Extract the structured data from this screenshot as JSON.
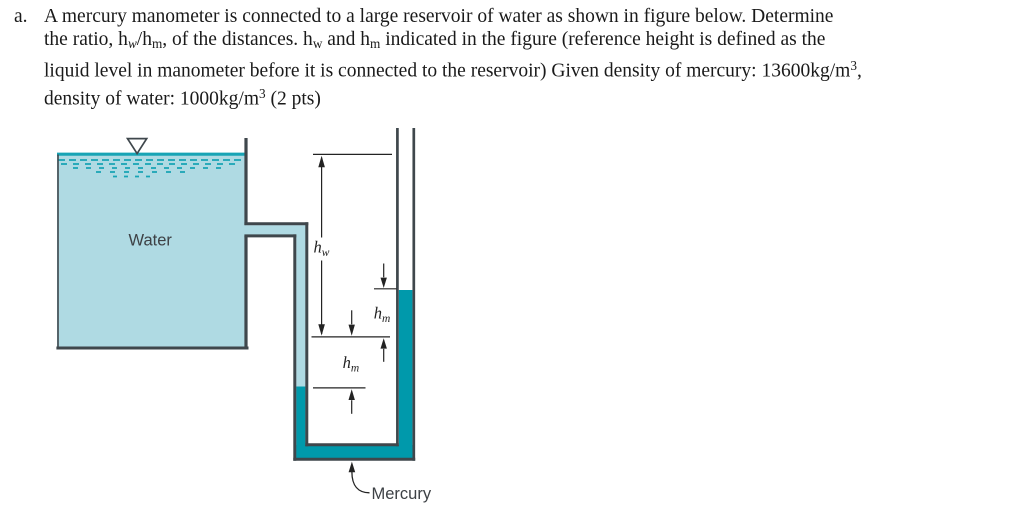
{
  "problem": {
    "marker": "a.",
    "lines": [
      [
        {
          "t": "A mercury manometer is connected to a large reservoir of water as shown in figure below. Determine"
        }
      ],
      [
        {
          "t": "the ratio, h"
        },
        {
          "t": "w",
          "sub": true,
          "i": true
        },
        {
          "t": "/h"
        },
        {
          "t": "m",
          "sub": true
        },
        {
          "t": ", of the distances. h"
        },
        {
          "t": "w",
          "sub": true
        },
        {
          "t": " and h"
        },
        {
          "t": "m",
          "sub": true
        },
        {
          "t": " indicated in the figure (reference height is defined as the"
        }
      ],
      [
        {
          "t": "liquid level in manometer before it is connected to the reservoir) Given density of mercury: 13600kg/m"
        },
        {
          "t": "3",
          "sup": true
        },
        {
          "t": ","
        }
      ],
      [
        {
          "t": "density of water: 1000kg/m"
        },
        {
          "t": "3",
          "sup": true
        },
        {
          "t": " (2 pts)"
        }
      ]
    ]
  },
  "figure": {
    "water_label": "Water",
    "mercury_label": "Mercury",
    "hw_label": {
      "base": "h",
      "sub": "w"
    },
    "hm_upper_label": {
      "base": "h",
      "sub": "m"
    },
    "hm_lower_label": {
      "base": "h",
      "sub": "m"
    },
    "colors": {
      "water": "#afdae3",
      "mercury": "#0099ab",
      "surface": "#18a4b5",
      "wall": "#3f474c",
      "annotation": "#232323",
      "label": "#3d4145"
    }
  }
}
